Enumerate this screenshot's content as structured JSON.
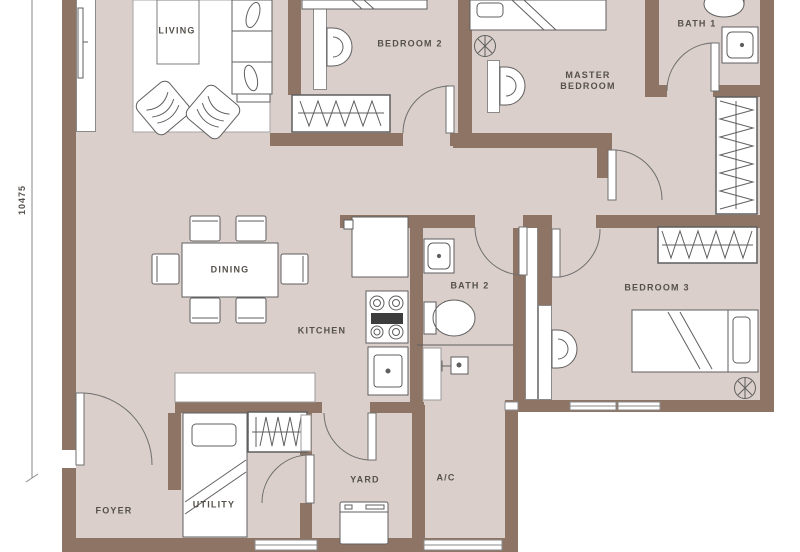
{
  "meta": {
    "type": "apartment-floor-plan",
    "canvas_width": 800,
    "canvas_height": 552
  },
  "colors": {
    "wall": "#8e7465",
    "floor": "#dacfca",
    "fixture_outline": "#5f5f5f",
    "label_text": "#55504a",
    "background": "#ffffff"
  },
  "dimensions": {
    "left_height": "10475"
  },
  "rooms": {
    "living": {
      "label": "LIVING"
    },
    "bedroom2": {
      "label": "BEDROOM 2"
    },
    "master": {
      "label_line1": "MASTER",
      "label_line2": "BEDROOM"
    },
    "bath1": {
      "label": "BATH 1"
    },
    "dining": {
      "label": "DINING"
    },
    "kitchen": {
      "label": "KITCHEN"
    },
    "bath2": {
      "label": "BATH 2"
    },
    "bedroom3": {
      "label": "BEDROOM 3"
    },
    "foyer": {
      "label": "FOYER"
    },
    "utility": {
      "label": "UTILITY"
    },
    "yard": {
      "label": "YARD"
    },
    "ac": {
      "label": "A/C"
    }
  },
  "fixtures": [
    "sofa",
    "armchair",
    "coffee-table",
    "rug",
    "tv",
    "dining-table",
    "dining-chair",
    "double-bed",
    "single-bed",
    "pillow",
    "wardrobe-hangers",
    "ceiling-fan",
    "wall-ac-unit",
    "toilet",
    "wash-basin",
    "shower-head",
    "refrigerator",
    "stove",
    "kitchen-sink",
    "washing-machine",
    "door-swing",
    "window"
  ]
}
